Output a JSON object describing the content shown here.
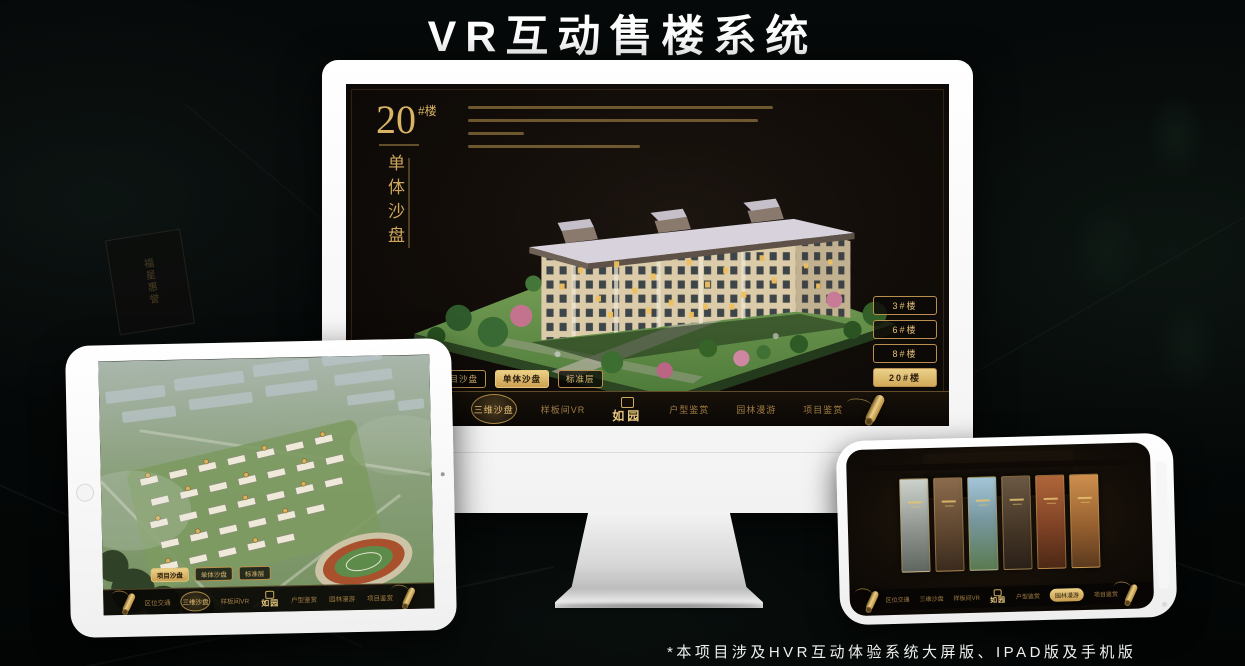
{
  "page": {
    "title": "VR互动售楼系统",
    "footnote": "*本项目涉及HVR互动体验系统大屏版、IPAD版及手机版"
  },
  "colors": {
    "gold": "#c9a155",
    "gold_selected": "#d9b05e",
    "screen_background": "#140f0a",
    "page_background": "#040707",
    "device_body": "#ffffff"
  },
  "background": {
    "plaque_text": "福星惠誉"
  },
  "brand": {
    "logo": "如园"
  },
  "monitor_app": {
    "block_number": "20",
    "block_unit": "#楼",
    "block_subtitle": "单体沙盘",
    "building_buttons": [
      {
        "label": "3#楼",
        "selected": false
      },
      {
        "label": "6#楼",
        "selected": false
      },
      {
        "label": "8#楼",
        "selected": false
      },
      {
        "label": "20#楼",
        "selected": true
      }
    ],
    "view_tabs": [
      {
        "label": "项目沙盘",
        "selected": false
      },
      {
        "label": "单体沙盘",
        "selected": true
      },
      {
        "label": "标准层",
        "selected": false
      }
    ],
    "nav_items": [
      {
        "label": "区位交通",
        "selected": false
      },
      {
        "label": "三维沙盘",
        "selected": true
      },
      {
        "label": "样板间VR",
        "selected": false
      },
      {
        "label": "户型鉴赏",
        "selected": false
      },
      {
        "label": "园林漫游",
        "selected": false
      },
      {
        "label": "项目鉴赏",
        "selected": false
      }
    ]
  },
  "tablet_app": {
    "view_tabs": [
      {
        "label": "项目沙盘",
        "selected": true
      },
      {
        "label": "单体沙盘",
        "selected": false
      },
      {
        "label": "标准层",
        "selected": false
      }
    ],
    "nav_items": [
      {
        "label": "区位交通",
        "selected": false
      },
      {
        "label": "三维沙盘",
        "selected": true
      },
      {
        "label": "样板间VR",
        "selected": false
      },
      {
        "label": "户型鉴赏",
        "selected": false
      },
      {
        "label": "园林漫游",
        "selected": false
      },
      {
        "label": "项目鉴赏",
        "selected": false
      }
    ]
  },
  "phone_app": {
    "nav_items": [
      {
        "label": "区位交通",
        "selected": false
      },
      {
        "label": "三维沙盘",
        "selected": false
      },
      {
        "label": "样板间VR",
        "selected": false
      },
      {
        "label": "户型鉴赏",
        "selected": false
      },
      {
        "label": "园林漫游",
        "selected": true
      },
      {
        "label": "项目鉴赏",
        "selected": false
      }
    ]
  }
}
